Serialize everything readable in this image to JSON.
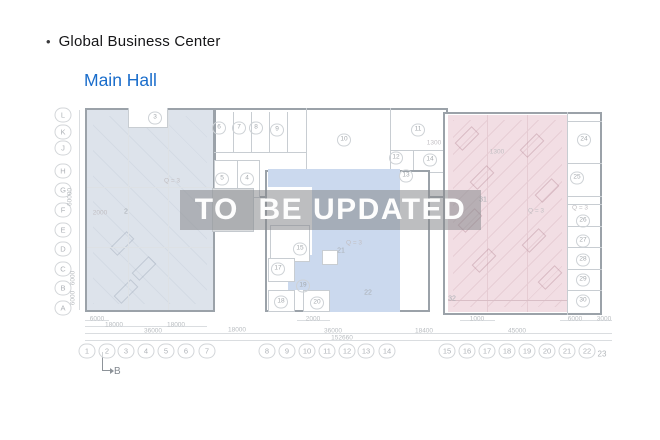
{
  "header": {
    "bullet": "•",
    "title": "Global Business Center",
    "hall_label": "Main Hall"
  },
  "watermark": {
    "text": "TO  BE UPDATED"
  },
  "colors": {
    "accent_blue": "#1a6dcb",
    "region_gray": "#dde3eb",
    "region_blue": "#cbd9ee",
    "region_pink": "#f2dee4",
    "watermark_band": "rgba(134,137,140,0.55)"
  },
  "plan": {
    "marker_b": "B",
    "row_axis": [
      {
        "label": "L",
        "x": 63,
        "y": 115
      },
      {
        "label": "K",
        "x": 63,
        "y": 132
      },
      {
        "label": "J",
        "x": 63,
        "y": 148
      },
      {
        "label": "H",
        "x": 63,
        "y": 171
      },
      {
        "label": "G",
        "x": 63,
        "y": 190
      },
      {
        "label": "F",
        "x": 63,
        "y": 210
      },
      {
        "label": "E",
        "x": 63,
        "y": 230
      },
      {
        "label": "D",
        "x": 63,
        "y": 249
      },
      {
        "label": "C",
        "x": 63,
        "y": 269
      },
      {
        "label": "B",
        "x": 63,
        "y": 288
      },
      {
        "label": "A",
        "x": 63,
        "y": 308
      }
    ],
    "col_axis": [
      {
        "label": "1",
        "x": 87,
        "y": 351
      },
      {
        "label": "2",
        "x": 107,
        "y": 351
      },
      {
        "label": "3",
        "x": 126,
        "y": 351
      },
      {
        "label": "4",
        "x": 146,
        "y": 351
      },
      {
        "label": "5",
        "x": 166,
        "y": 351
      },
      {
        "label": "6",
        "x": 186,
        "y": 351
      },
      {
        "label": "7",
        "x": 207,
        "y": 351
      },
      {
        "label": "8",
        "x": 267,
        "y": 351
      },
      {
        "label": "9",
        "x": 287,
        "y": 351
      },
      {
        "label": "10",
        "x": 307,
        "y": 351
      },
      {
        "label": "11",
        "x": 327,
        "y": 351
      },
      {
        "label": "12",
        "x": 347,
        "y": 351
      },
      {
        "label": "13",
        "x": 366,
        "y": 351
      },
      {
        "label": "14",
        "x": 387,
        "y": 351
      },
      {
        "label": "15",
        "x": 447,
        "y": 351
      },
      {
        "label": "16",
        "x": 467,
        "y": 351
      },
      {
        "label": "17",
        "x": 487,
        "y": 351
      },
      {
        "label": "18",
        "x": 507,
        "y": 351
      },
      {
        "label": "19",
        "x": 527,
        "y": 351
      },
      {
        "label": "20",
        "x": 547,
        "y": 351
      },
      {
        "label": "21",
        "x": 567,
        "y": 351
      },
      {
        "label": "22",
        "x": 587,
        "y": 351
      }
    ],
    "col_axis_plain": {
      "label": "23",
      "x": 602,
      "y": 354
    },
    "rooms_circled": [
      {
        "n": "3",
        "x": 155,
        "y": 118
      },
      {
        "n": "6",
        "x": 219,
        "y": 128
      },
      {
        "n": "7",
        "x": 239,
        "y": 128
      },
      {
        "n": "8",
        "x": 256,
        "y": 128
      },
      {
        "n": "9",
        "x": 277,
        "y": 130
      },
      {
        "n": "10",
        "x": 344,
        "y": 140
      },
      {
        "n": "11",
        "x": 418,
        "y": 130
      },
      {
        "n": "12",
        "x": 396,
        "y": 158
      },
      {
        "n": "13",
        "x": 406,
        "y": 176
      },
      {
        "n": "14",
        "x": 430,
        "y": 160
      },
      {
        "n": "5",
        "x": 222,
        "y": 179
      },
      {
        "n": "4",
        "x": 247,
        "y": 179
      },
      {
        "n": "15",
        "x": 300,
        "y": 249
      },
      {
        "n": "17",
        "x": 278,
        "y": 269
      },
      {
        "n": "19",
        "x": 303,
        "y": 286
      },
      {
        "n": "18",
        "x": 281,
        "y": 302
      },
      {
        "n": "20",
        "x": 317,
        "y": 303
      },
      {
        "n": "24",
        "x": 584,
        "y": 140
      },
      {
        "n": "25",
        "x": 577,
        "y": 178
      },
      {
        "n": "26",
        "x": 583,
        "y": 221
      },
      {
        "n": "27",
        "x": 583,
        "y": 241
      },
      {
        "n": "28",
        "x": 583,
        "y": 260
      },
      {
        "n": "29",
        "x": 583,
        "y": 280
      },
      {
        "n": "30",
        "x": 583,
        "y": 301
      }
    ],
    "rooms_plain": [
      {
        "n": "2",
        "x": 126,
        "y": 212
      },
      {
        "n": "21",
        "x": 341,
        "y": 251
      },
      {
        "n": "22",
        "x": 368,
        "y": 293
      },
      {
        "n": "31",
        "x": 483,
        "y": 200
      },
      {
        "n": "32",
        "x": 452,
        "y": 299
      }
    ],
    "annotations": [
      {
        "t": "Q = 3",
        "x": 172,
        "y": 181
      },
      {
        "t": "Q = 3",
        "x": 354,
        "y": 243
      },
      {
        "t": "Q = 3",
        "x": 536,
        "y": 211
      },
      {
        "t": "Q = 3",
        "x": 580,
        "y": 208
      },
      {
        "t": "1300",
        "x": 434,
        "y": 143
      },
      {
        "t": "1300",
        "x": 497,
        "y": 152
      },
      {
        "t": "2000",
        "x": 100,
        "y": 213
      }
    ],
    "dims_bottom": [
      {
        "t": "6000",
        "x": 97,
        "y": 319
      },
      {
        "t": "18000",
        "x": 114,
        "y": 325
      },
      {
        "t": "18000",
        "x": 176,
        "y": 325
      },
      {
        "t": "2000",
        "x": 313,
        "y": 319
      },
      {
        "t": "1000",
        "x": 477,
        "y": 319
      },
      {
        "t": "6000",
        "x": 575,
        "y": 319
      },
      {
        "t": "3000",
        "x": 604,
        "y": 319
      },
      {
        "t": "36000",
        "x": 153,
        "y": 331
      },
      {
        "t": "18000",
        "x": 237,
        "y": 330
      },
      {
        "t": "36000",
        "x": 333,
        "y": 331
      },
      {
        "t": "18400",
        "x": 424,
        "y": 331
      },
      {
        "t": "45000",
        "x": 517,
        "y": 331
      },
      {
        "t": "152660",
        "x": 342,
        "y": 338
      }
    ],
    "dims_left": [
      {
        "t": "60000",
        "x": 70,
        "y": 197
      },
      {
        "t": "6000",
        "x": 73,
        "y": 278
      },
      {
        "t": "6000",
        "x": 73,
        "y": 298
      }
    ]
  }
}
